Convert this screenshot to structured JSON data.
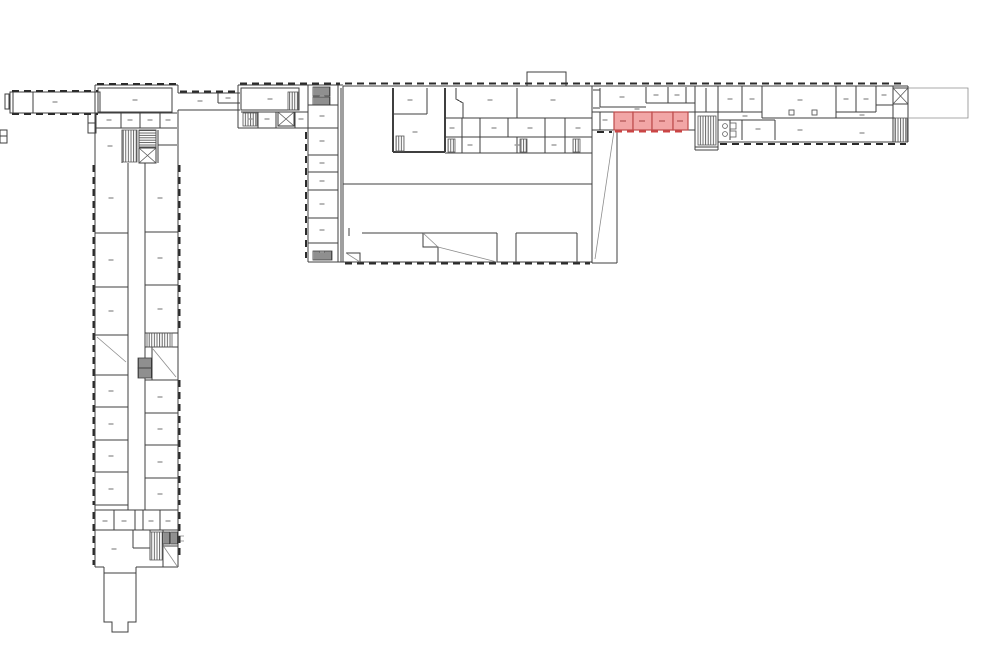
{
  "canvas": {
    "width": 1000,
    "height": 666,
    "background": "#ffffff"
  },
  "colors": {
    "wall": "#3f3f3f",
    "thin": "#5a5a5a",
    "light": "#8c8c8c",
    "window": "#2b2b2b",
    "label": "#9a9a9a",
    "highlight_fill": "#F2A6A6",
    "highlight_stroke": "#BE4B4B",
    "highlight_label": "#C06868",
    "highlight_window": "#CC4444"
  },
  "highlight": {
    "rooms": [
      [
        614,
        112,
        19,
        18
      ],
      [
        633,
        112,
        19,
        18
      ],
      [
        652,
        112,
        21,
        18
      ],
      [
        673,
        112,
        15,
        18
      ]
    ],
    "labels": [
      [
        623,
        121
      ],
      [
        642,
        121
      ],
      [
        662,
        121
      ],
      [
        680,
        121
      ]
    ],
    "window_run": [
      615,
      131.5,
      687,
      131.5
    ]
  },
  "plan": {
    "walls": [
      "M10 92 H100 V113 H10 Z",
      "M13 92 V113",
      "M33 92 V113",
      "M5 94 h4 v15 h-4 Z",
      "M0 130 h7 v13 h-7 Z",
      "M0 136 h7",
      "M95 85 H178",
      "M95 85 V567",
      "M178 85 V93",
      "M178 110 V567",
      "M98 88 H172 V112 H98 Z",
      "M96 113 H177",
      "M96 128 H177",
      "M121 113 V128",
      "M140 113 V128",
      "M160 113 V128",
      "M122 130 V163",
      "M139 130 H156",
      "M139 130 V147",
      "M156 130 V163",
      "M139 147 H156",
      "M158 130 V163",
      "M158 145 H177",
      "M88 113 h8 v20 h-8 Z",
      "M88 123 h8",
      "M128 163 V510",
      "M145 163 V510",
      "M95 233 H128",
      "M95 287 H128",
      "M95 335 H128",
      "M95 375 H128",
      "M95 407 H128",
      "M95 440 H128",
      "M95 472 H128",
      "M95 505 H128",
      "M145 232 H178",
      "M145 285 H178",
      "M145 333 H178",
      "M145 347 H178",
      "M152 347 V380",
      "M145 380 H178",
      "M145 413 H178",
      "M145 445 H178",
      "M145 478 H178",
      "M95 510 H178",
      "M114 510 V530",
      "M135 510 V530",
      "M143 510 V530",
      "M160 510 V530",
      "M95 530 H178",
      "M133 530 V548",
      "M133 548 H150",
      "M150 530 V560",
      "M163 530 V567",
      "M163 546 H178",
      "M95 567 H104",
      "M136 567 H178",
      "M104 567 V622 H112 V632 H128 V622 H136 V567",
      "M104 573 H136",
      "M178 93 H240",
      "M178 110 H240",
      "M218 93 V103",
      "M218 103 H240",
      "M238 85 H343",
      "M238 85 V128",
      "M238 128 H308",
      "M241 88 h58 v22 h-58 Z",
      "M241 112 H308",
      "M258 112 V128",
      "M276 112 V128",
      "M295 112 V128",
      "M308 85 V262",
      "M338 85 V262",
      "M341 88 V262",
      "M308 262 H343",
      "M308 105 H338",
      "M308 128 H338",
      "M308 155 H338",
      "M308 172 H338",
      "M308 190 H338",
      "M308 218 H338",
      "M308 243 H338",
      "M343 86 H592",
      "M343 86 V262",
      "M343 262 H592",
      "M592 86 V263",
      "M527 86 V72 H566 V86",
      "M427 88 V114",
      "M393 114 H427",
      "M456 88 V99 L463 103 V118",
      "M517 88 V118",
      "M445 118 H592",
      "M445 137 H592",
      "M462 118 V137",
      "M480 118 V137",
      "M508 118 V137",
      "M545 118 V137",
      "M565 118 V137",
      "M445 153 H592",
      "M462 137 V153",
      "M480 137 V153",
      "M517 137 V153",
      "M545 137 V153",
      "M565 137 V153",
      "M343 184 H592",
      "M362 233 H497",
      "M349 228 V236",
      "M423 233 V247 H438 V262",
      "M497 233 V262",
      "M516 233 H577",
      "M516 233 V262",
      "M577 233 V262",
      "M346 253 H360 V262",
      "M617 131 V263",
      "M592 263 H617",
      "M592 86 H908",
      "M592 112 H614",
      "M688 112 H695",
      "M592 130 H614",
      "M688 130 H695",
      "M600 88 V107",
      "M600 107 H646",
      "M646 87 V103",
      "M646 103 H695",
      "M668 87 V103",
      "M686 87 V103",
      "M593 90 H600",
      "M593 108 H600",
      "M600 112 V130",
      "M695 86 V150",
      "M718 86 V150",
      "M695 150 H718",
      "M706 88 V112",
      "M695 112 H718",
      "M695 147 H718",
      "M718 112 H762",
      "M742 86 V112",
      "M762 86 V118",
      "M762 118 H836",
      "M836 86 V118",
      "M856 86 V112",
      "M876 86 V112",
      "M836 112 H876",
      "M876 105 H893",
      "M893 86 V105",
      "M836 118 H895",
      "M718 120 H775",
      "M730 120 V140",
      "M742 120 V140",
      "M775 120 V140",
      "M893 105 V142",
      "M718 142 H908",
      "M908 86 V142"
    ],
    "thick_walls": [
      "M393 88 V152",
      "M445 88 V152",
      "M393 152 H445"
    ],
    "light_lines": [
      "M97 337 L126 362",
      "M153 349 L176 377",
      "M164 547 L177 566",
      "M178 536 h6",
      "M178 541 h6",
      "M423 233 L438 247",
      "M438 247 L497 262",
      "M346 253 L360 262",
      "M614 131 L595 259",
      "M908 88 H968 V118 H908"
    ],
    "stair_hatches": [
      [
        122,
        130,
        15,
        32
      ],
      [
        288,
        92,
        10,
        18
      ],
      [
        243,
        113,
        14,
        13
      ],
      [
        396,
        136,
        8,
        15
      ],
      [
        448,
        139,
        7,
        13
      ],
      [
        520,
        139,
        7,
        13
      ],
      [
        573,
        139,
        7,
        13
      ],
      [
        147,
        333,
        25,
        14
      ],
      [
        150,
        532,
        13,
        28
      ],
      [
        698,
        116,
        18,
        29
      ],
      [
        895,
        118,
        12,
        24
      ]
    ],
    "dense_blocks": [
      [
        313,
        87,
        17,
        9
      ],
      [
        313,
        97,
        17,
        8
      ],
      [
        313,
        251,
        19,
        9
      ],
      [
        138,
        358,
        14,
        10
      ],
      [
        138,
        368,
        14,
        10
      ],
      [
        163,
        532,
        7,
        12
      ],
      [
        171,
        532,
        7,
        12
      ]
    ],
    "elevator_hatch": [
      [
        139,
        130,
        17,
        17
      ]
    ],
    "x_boxes": [
      [
        139,
        148,
        17,
        15
      ],
      [
        278,
        112,
        16,
        14
      ],
      [
        893,
        88,
        15,
        16
      ]
    ],
    "window_runs": [
      [
        12,
        91,
        98,
        91
      ],
      [
        12,
        114,
        98,
        114
      ],
      [
        97,
        84,
        176,
        84
      ],
      [
        93.5,
        165,
        93.5,
        505
      ],
      [
        179.5,
        165,
        179.5,
        330
      ],
      [
        179.5,
        380,
        179.5,
        505
      ],
      [
        93.5,
        512,
        93.5,
        565
      ],
      [
        179.5,
        512,
        179.5,
        560
      ],
      [
        180,
        91.5,
        236,
        91.5
      ],
      [
        240,
        83.5,
        340,
        83.5
      ],
      [
        306,
        132,
        306,
        258
      ],
      [
        345,
        83.5,
        590,
        83.5
      ],
      [
        345,
        263.5,
        590,
        263.5
      ],
      [
        594,
        83.5,
        906,
        83.5
      ],
      [
        720,
        144,
        906,
        144
      ],
      [
        597,
        132,
        612,
        132
      ]
    ],
    "labels": [
      [
        55,
        102
      ],
      [
        135,
        100
      ],
      [
        109,
        120
      ],
      [
        130,
        120
      ],
      [
        150,
        120
      ],
      [
        168,
        120
      ],
      [
        110,
        146
      ],
      [
        111,
        198
      ],
      [
        111,
        260
      ],
      [
        111,
        311
      ],
      [
        111,
        391
      ],
      [
        111,
        424
      ],
      [
        111,
        456
      ],
      [
        111,
        489
      ],
      [
        160,
        198
      ],
      [
        160,
        258
      ],
      [
        160,
        309
      ],
      [
        160,
        397
      ],
      [
        160,
        429
      ],
      [
        160,
        462
      ],
      [
        160,
        494
      ],
      [
        105,
        521
      ],
      [
        124,
        521
      ],
      [
        151,
        521
      ],
      [
        168,
        521
      ],
      [
        114,
        549
      ],
      [
        200,
        101
      ],
      [
        228,
        98
      ],
      [
        270,
        99
      ],
      [
        250,
        119
      ],
      [
        267,
        119
      ],
      [
        301,
        119
      ],
      [
        322,
        96
      ],
      [
        322,
        116
      ],
      [
        322,
        141
      ],
      [
        322,
        163
      ],
      [
        322,
        181
      ],
      [
        322,
        204
      ],
      [
        322,
        230
      ],
      [
        322,
        252
      ],
      [
        410,
        100
      ],
      [
        415,
        132
      ],
      [
        490,
        100
      ],
      [
        553,
        100
      ],
      [
        452,
        128
      ],
      [
        494,
        128
      ],
      [
        530,
        128
      ],
      [
        578,
        128
      ],
      [
        470,
        145
      ],
      [
        517,
        145
      ],
      [
        554,
        145
      ],
      [
        622,
        97
      ],
      [
        656,
        95
      ],
      [
        677,
        95
      ],
      [
        605,
        120
      ],
      [
        637,
        109
      ],
      [
        730,
        99
      ],
      [
        752,
        99
      ],
      [
        800,
        100
      ],
      [
        846,
        99
      ],
      [
        866,
        99
      ],
      [
        884,
        95
      ],
      [
        745,
        116
      ],
      [
        862,
        115
      ],
      [
        758,
        129
      ],
      [
        800,
        130
      ],
      [
        862,
        133
      ]
    ],
    "columns": [
      [
        789,
        110,
        5,
        5
      ],
      [
        812,
        110,
        5,
        5
      ]
    ],
    "fixtures": {
      "circles": [
        [
          725,
          126
        ],
        [
          725,
          134
        ]
      ],
      "rects": [
        [
          730,
          123,
          6,
          6
        ],
        [
          730,
          131,
          6,
          6
        ]
      ]
    }
  }
}
